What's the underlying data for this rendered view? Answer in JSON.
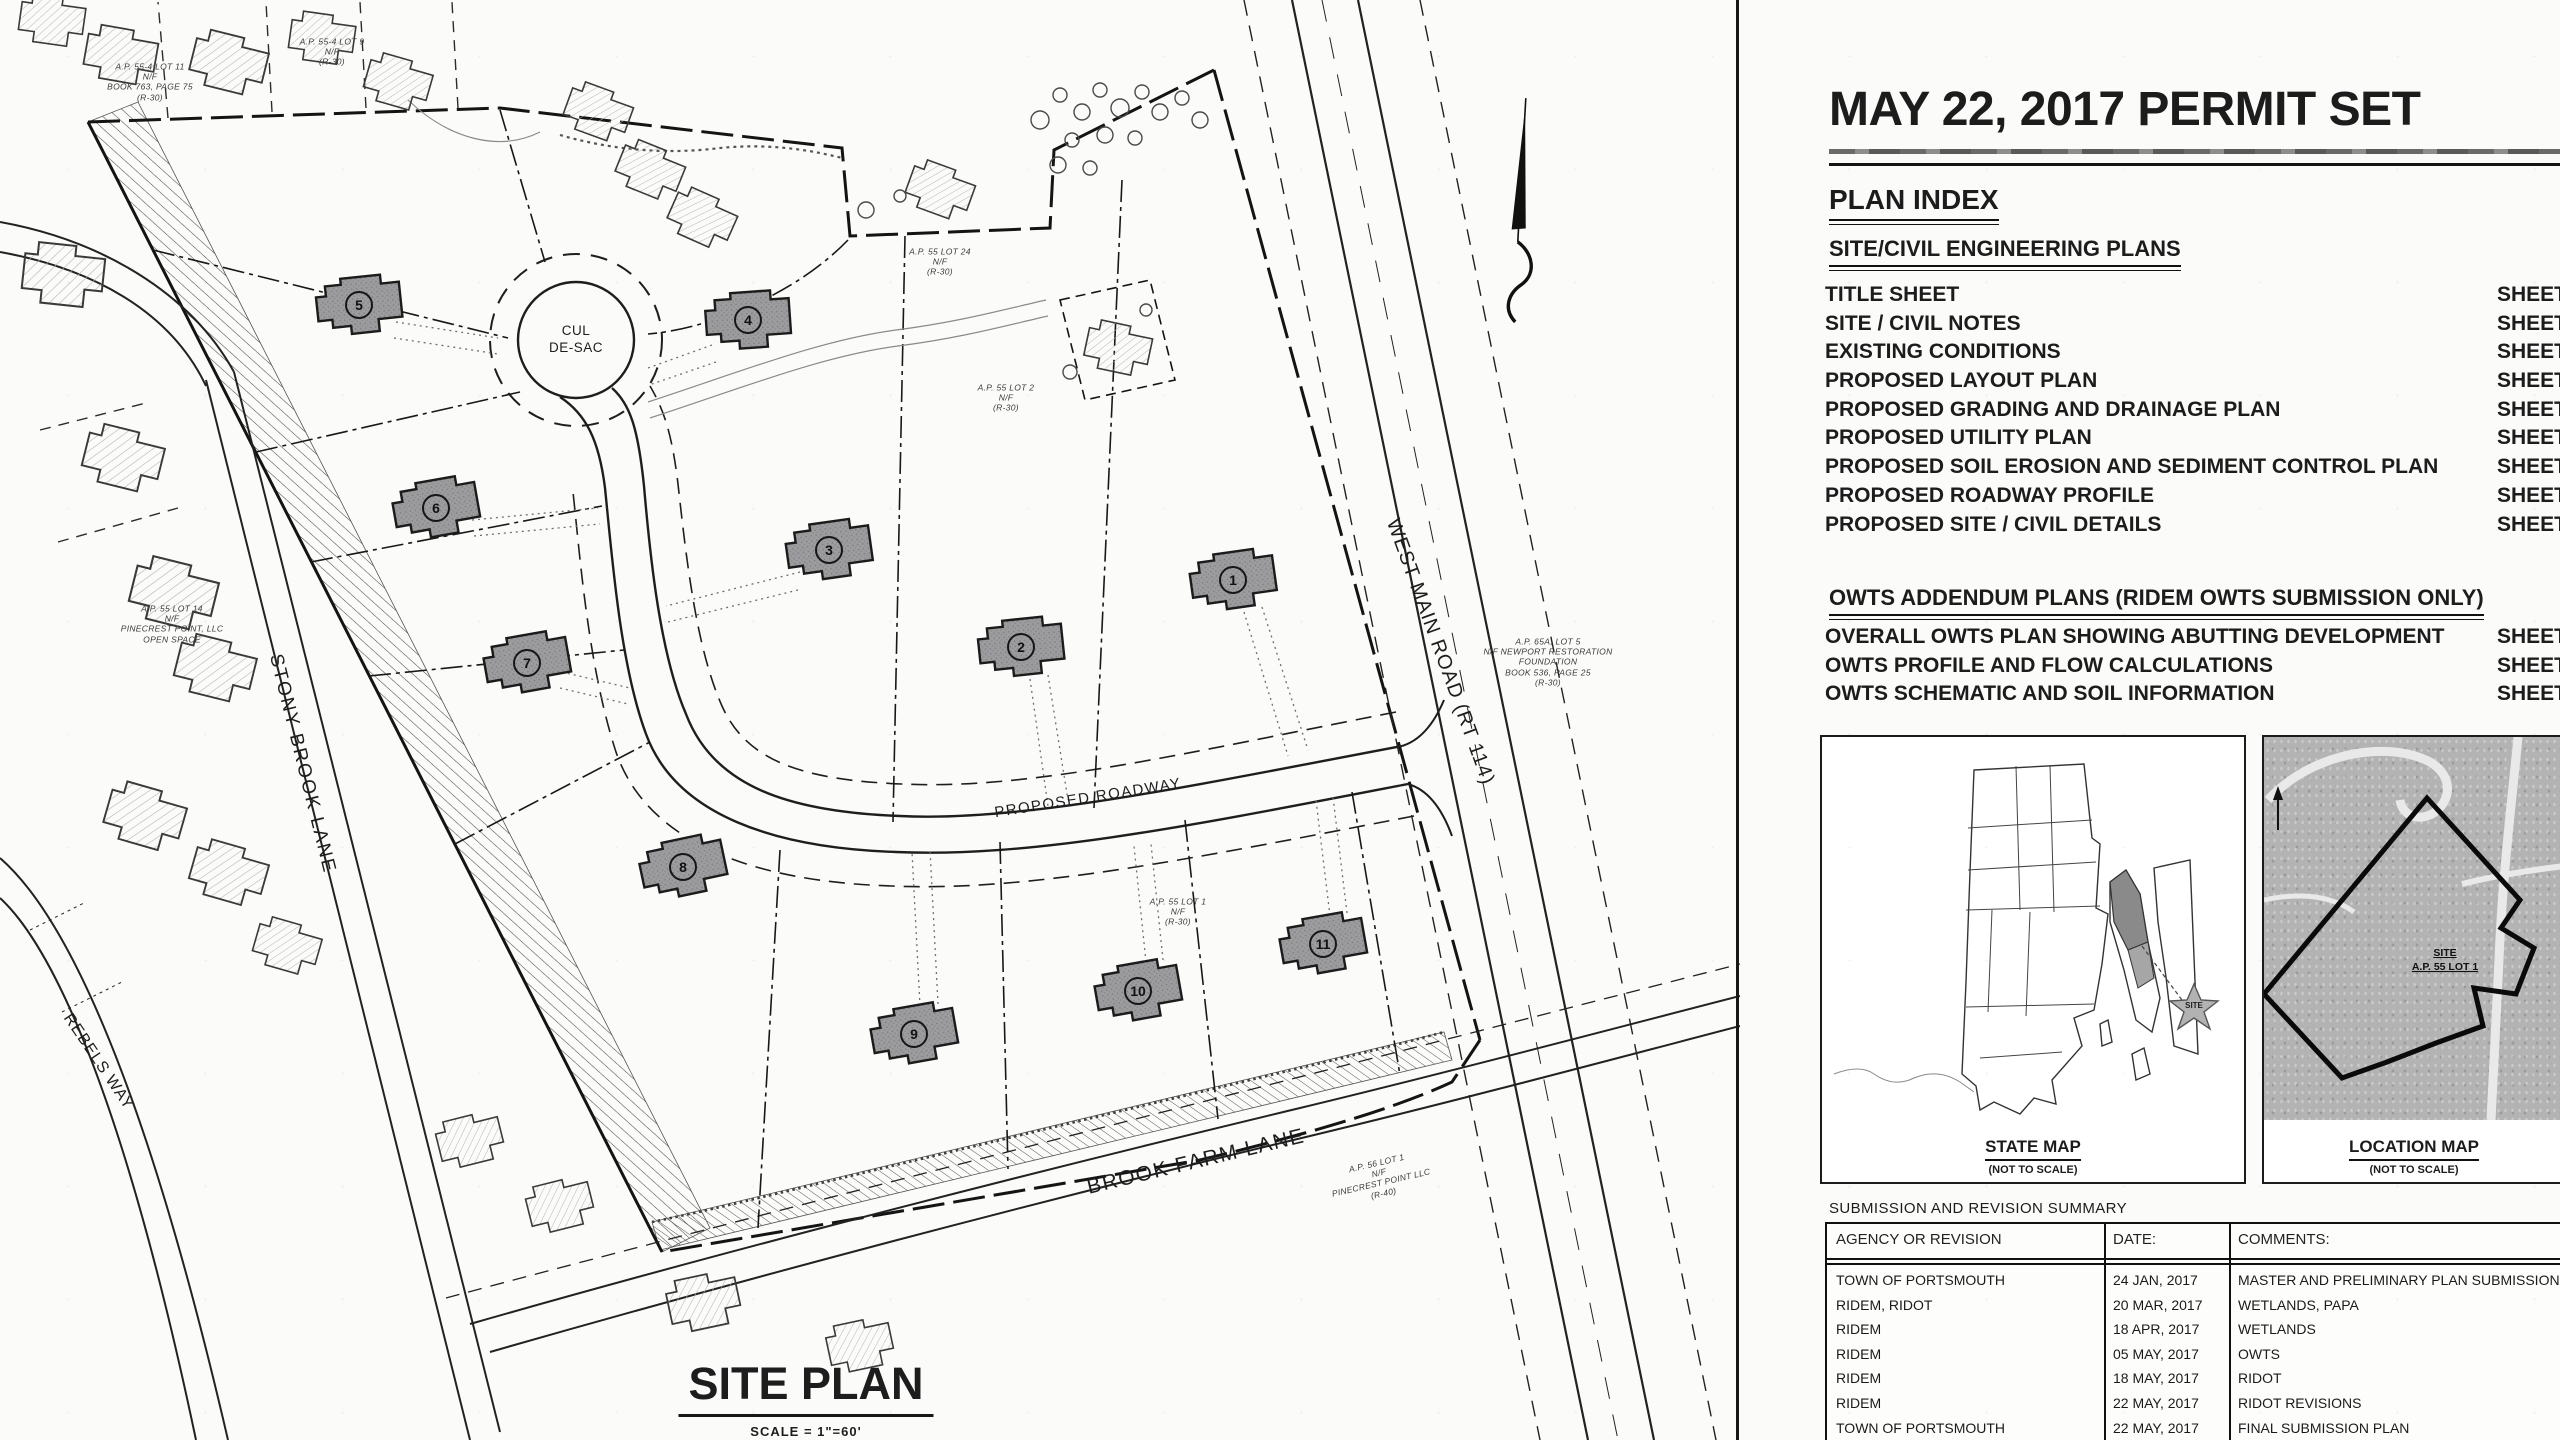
{
  "site_plan": {
    "title": "SITE PLAN",
    "scale_note": "SCALE =  1\"=60'",
    "road_labels": {
      "cul_de_sac": "CUL\nDE-SAC",
      "proposed_roadway": "PROPOSED ROADWAY",
      "brook_farm_lane": "BROOK FARM LANE",
      "stony_brook_lane": "STONY BROOK LANE",
      "west_main_road": "WEST MAIN ROAD (RT 114)",
      "rebels_way": "REBELS WAY"
    },
    "lots": [
      {
        "n": "1"
      },
      {
        "n": "2"
      },
      {
        "n": "3"
      },
      {
        "n": "4"
      },
      {
        "n": "5"
      },
      {
        "n": "6"
      },
      {
        "n": "7"
      },
      {
        "n": "8"
      },
      {
        "n": "9"
      },
      {
        "n": "10"
      },
      {
        "n": "11"
      }
    ],
    "annotations": [
      {
        "text": "A.P. 55-4 LOT 11\nN/F\nBOOK 763, PAGE 75\n(R-30)"
      },
      {
        "text": "A.P. 55-4 LOT 9\nN/F\n(R-30)"
      },
      {
        "text": "A.P. 55 LOT 24\nN/F\n(R-30)"
      },
      {
        "text": "A.P. 55 LOT 2\nN/F\n(R-30)"
      },
      {
        "text": "A.P. 65A, LOT 5\nN/F NEWPORT RESTORATION\nFOUNDATION\nBOOK 536, PAGE 25\n(R-30)"
      },
      {
        "text": "A.P. 56 LOT 1\nN/F\nPINECREST POINT LLC\n(R-40)"
      },
      {
        "text": "A.P. 55 LOT 14\nN/F\nPINECREST POINT, LLC\nOPEN SPACE"
      },
      {
        "text": "A.P. 55 LOT 1\nN/F\n(R-30)"
      }
    ]
  },
  "title_block": {
    "title": "MAY 22, 2017 PERMIT SET",
    "plan_index_heading": "PLAN INDEX",
    "sections": [
      {
        "heading": "SITE/CIVIL ENGINEERING PLANS",
        "items": [
          {
            "label": "TITLE SHEET",
            "sheet": "SHEET"
          },
          {
            "label": "SITE / CIVIL NOTES",
            "sheet": "SHEET"
          },
          {
            "label": "EXISTING CONDITIONS",
            "sheet": "SHEET"
          },
          {
            "label": "PROPOSED LAYOUT PLAN",
            "sheet": "SHEET"
          },
          {
            "label": "PROPOSED GRADING AND DRAINAGE PLAN",
            "sheet": "SHEET"
          },
          {
            "label": "PROPOSED UTILITY PLAN",
            "sheet": "SHEET"
          },
          {
            "label": "PROPOSED SOIL EROSION AND SEDIMENT CONTROL PLAN",
            "sheet": "SHEET"
          },
          {
            "label": "PROPOSED ROADWAY PROFILE",
            "sheet": "SHEET"
          },
          {
            "label": "PROPOSED SITE / CIVIL DETAILS",
            "sheet": "SHEET"
          }
        ]
      },
      {
        "heading": "OWTS ADDENDUM PLANS (RIDEM OWTS SUBMISSION ONLY)",
        "items": [
          {
            "label": "OVERALL OWTS PLAN SHOWING ABUTTING DEVELOPMENT",
            "sheet": "SHEET"
          },
          {
            "label": "OWTS PROFILE AND FLOW CALCULATIONS",
            "sheet": "SHEET"
          },
          {
            "label": "OWTS SCHEMATIC AND SOIL INFORMATION",
            "sheet": "SHEET"
          }
        ]
      }
    ],
    "maps": {
      "state": {
        "label": "STATE MAP",
        "note": "(NOT TO SCALE)",
        "site": "SITE"
      },
      "location": {
        "label": "LOCATION MAP",
        "note": "(NOT TO SCALE)",
        "site_line1": "SITE",
        "site_line2": "A.P. 55 LOT 1"
      }
    },
    "revisions": {
      "title": "SUBMISSION AND REVISION SUMMARY",
      "columns": [
        "AGENCY OR REVISION",
        "DATE:",
        "COMMENTS:"
      ],
      "rows": [
        [
          "TOWN OF PORTSMOUTH",
          "24 JAN, 2017",
          "MASTER AND PRELIMINARY PLAN SUBMISSION"
        ],
        [
          "RIDEM, RIDOT",
          "20 MAR, 2017",
          "WETLANDS, PAPA"
        ],
        [
          "RIDEM",
          "18 APR, 2017",
          "WETLANDS"
        ],
        [
          "RIDEM",
          "05 MAY, 2017",
          "OWTS"
        ],
        [
          "RIDEM",
          "18 MAY, 2017",
          "RIDOT"
        ],
        [
          "RIDEM",
          "22 MAY, 2017",
          "RIDOT REVISIONS"
        ],
        [
          "TOWN OF PORTSMOUTH",
          "22 MAY, 2017",
          "FINAL SUBMISSION PLAN"
        ]
      ]
    }
  }
}
